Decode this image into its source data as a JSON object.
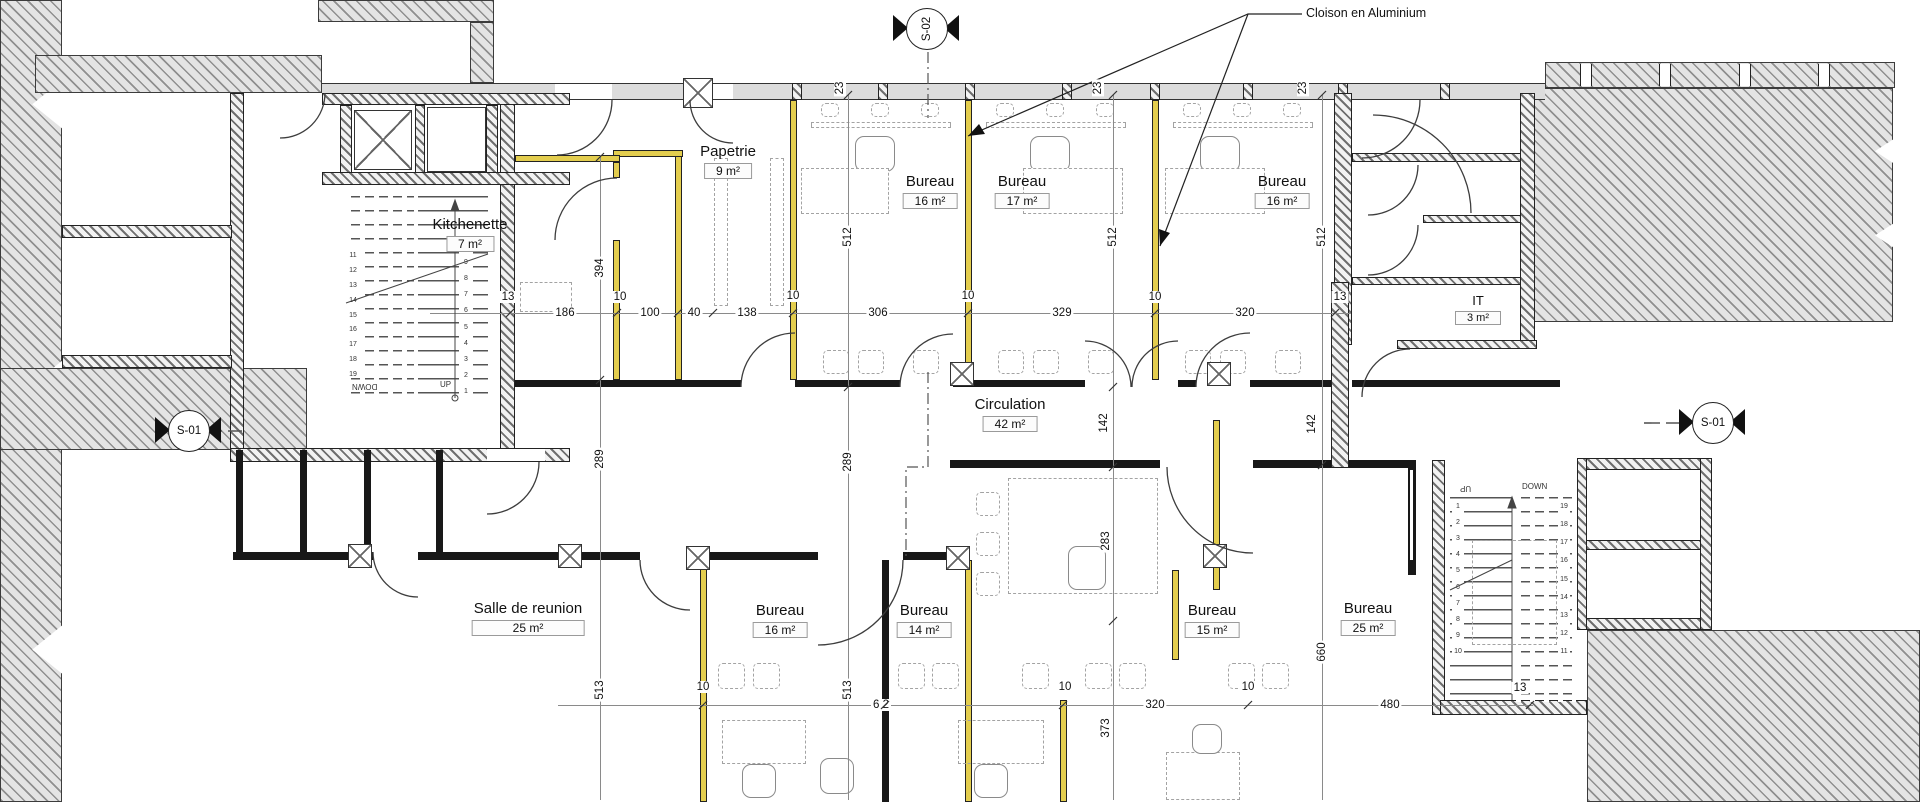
{
  "annotation": {
    "cloison": "Cloison en Aluminium"
  },
  "markers": {
    "s01_left": "S-01",
    "s01_right": "S-01",
    "s02_top": "S-02"
  },
  "rooms": {
    "papetrie": {
      "name": "Papetrie",
      "area": "9 m²"
    },
    "kitchenette": {
      "name": "Kitchenette",
      "area": "7 m²"
    },
    "bureau_top_1": {
      "name": "Bureau",
      "area": "16 m²"
    },
    "bureau_top_2": {
      "name": "Bureau",
      "area": "17 m²"
    },
    "bureau_top_3": {
      "name": "Bureau",
      "area": "16 m²"
    },
    "it": {
      "name": "IT",
      "area": "3 m²"
    },
    "circulation": {
      "name": "Circulation",
      "area": "42 m²"
    },
    "salle_reunion": {
      "name": "Salle de reunion",
      "area": "25 m²"
    },
    "bureau_bottom_1": {
      "name": "Bureau",
      "area": "16 m²"
    },
    "bureau_bottom_2": {
      "name": "Bureau",
      "area": "14 m²"
    },
    "bureau_bottom_3": {
      "name": "Bureau",
      "area": "15 m²"
    },
    "bureau_bottom_4": {
      "name": "Bureau",
      "area": "25 m²"
    }
  },
  "dims": {
    "chain_mid": [
      "13",
      "186",
      "100",
      "40",
      "138",
      "306",
      "329",
      "320",
      "13"
    ],
    "chain_bottom": [
      "6 2",
      "320",
      "480",
      "13"
    ],
    "ten": "10",
    "t23": "23",
    "v512": "512",
    "v394": "394",
    "v289": "289",
    "v513": "513",
    "v142": "142",
    "v283": "283",
    "v660": "660",
    "v373": "373"
  },
  "stairs": {
    "up": "UP",
    "down": "DOWN",
    "flight1": [
      "1",
      "2",
      "3",
      "4",
      "5",
      "6",
      "7",
      "8",
      "9",
      "10"
    ],
    "flight2": [
      "11",
      "12",
      "13",
      "14",
      "15",
      "16",
      "17",
      "18",
      "19"
    ]
  },
  "colors": {
    "partition": "#e3cd4e",
    "hatch": "#9a9a9a",
    "wall": "#181818"
  }
}
